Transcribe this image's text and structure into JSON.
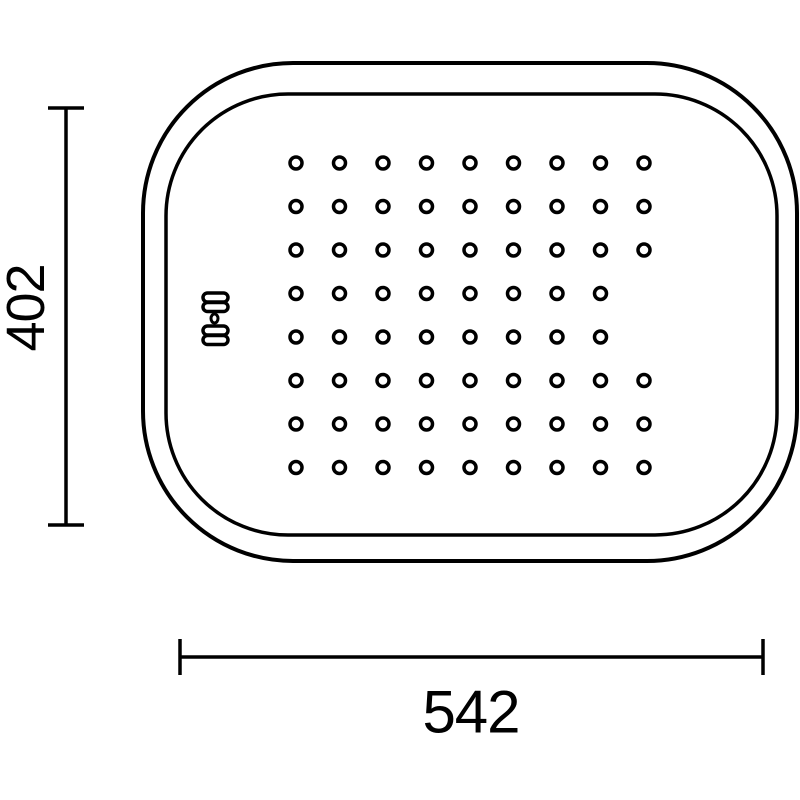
{
  "page": {
    "background": "#ffffff",
    "description": "Technical dimension drawing of a perforated drainer tray insert, top view"
  },
  "drawing": {
    "line_color": "#000000",
    "outer_shape": {
      "x": 143,
      "y": 63,
      "width": 654,
      "height": 498,
      "corner_radius": 150,
      "stroke_width": 4
    },
    "inner_shape": {
      "x": 166,
      "y": 94,
      "width": 611,
      "height": 441,
      "corner_radius": 122,
      "stroke_width": 3.5
    },
    "holes": {
      "rows": 8,
      "cols": 9,
      "start_x": 296,
      "start_y": 163,
      "spacing_x": 43.5,
      "spacing_y": 43.5,
      "radius": 6,
      "stroke_width": 3.5,
      "missing": [
        [
          3,
          8
        ],
        [
          4,
          8
        ]
      ]
    },
    "brand_mark": {
      "stroke_width": 3.5,
      "pills": [
        {
          "x": 203,
          "y": 293,
          "w": 25,
          "h": 9
        },
        {
          "x": 203,
          "y": 302.5,
          "w": 25,
          "h": 9
        },
        {
          "x": 203,
          "y": 326,
          "w": 25,
          "h": 9
        },
        {
          "x": 203,
          "y": 335.5,
          "w": 25,
          "h": 9
        }
      ],
      "oval": {
        "cx": 214.5,
        "cy": 318.5,
        "rx": 3.5,
        "ry": 4.5,
        "stroke_width": 3
      }
    },
    "dimensions": {
      "height": {
        "label": "402",
        "line_x": 66,
        "y1": 108,
        "y2": 525,
        "tick_half": 18,
        "stroke_width": 3.5,
        "label_x": 26,
        "label_y": 308,
        "font_size": 54,
        "rotation": -90
      },
      "width": {
        "label": "542",
        "line_y": 657,
        "x1": 180,
        "x2": 763,
        "tick_half": 18,
        "stroke_width": 3.5,
        "label_x": 471,
        "label_y": 712,
        "font_size": 60,
        "rotation": 0
      }
    }
  }
}
